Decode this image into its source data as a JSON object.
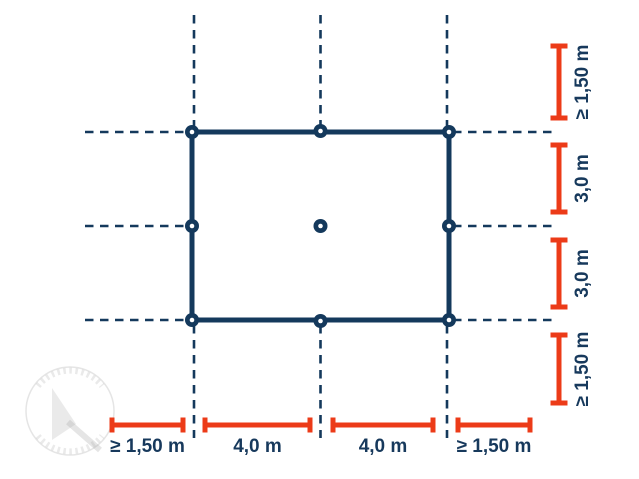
{
  "colors": {
    "background": "#FFFFFF",
    "outline": "#14395C",
    "dimension": "#EC3B18",
    "label": "#17395C"
  },
  "diagram": {
    "anchor_point_count": 9,
    "labels": {
      "right": [
        {
          "text": "≥ 1,50 m"
        },
        {
          "text": "3,0 m"
        },
        {
          "text": "3,0 m"
        },
        {
          "text": "≥ 1,50 m"
        }
      ],
      "bottom": [
        {
          "text": "≥ 1,50 m"
        },
        {
          "text": "4,0 m"
        },
        {
          "text": "4,0 m"
        },
        {
          "text": "≥ 1,50 m"
        }
      ]
    }
  }
}
